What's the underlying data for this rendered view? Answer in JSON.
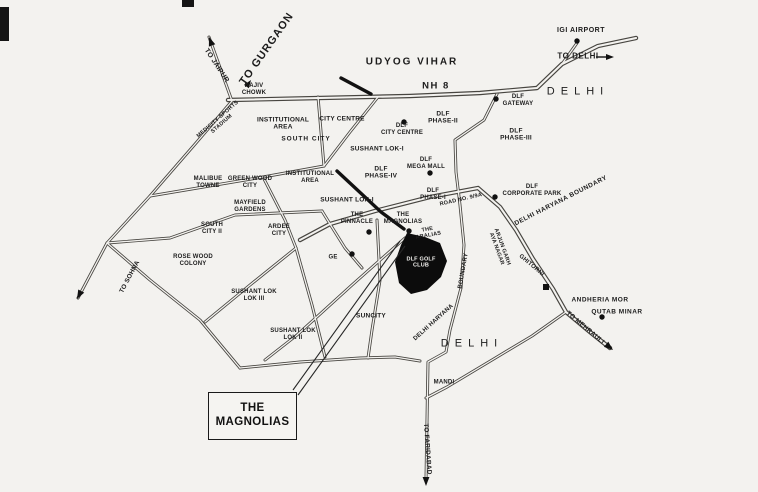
{
  "callout": {
    "text": "THE\nMAGNOLIAS"
  },
  "labels": [
    {
      "id": "to-jaipur",
      "text": "TO JAIPUR"
    },
    {
      "id": "to-gurgaon",
      "text": "TO GURGAON"
    },
    {
      "id": "udyog-vihar",
      "text": "UDYOG VIHAR"
    },
    {
      "id": "nh-8",
      "text": "NH 8"
    },
    {
      "id": "igi-airport",
      "text": "IGI AIRPORT"
    },
    {
      "id": "to-delhi",
      "text": "TO DELHI"
    },
    {
      "id": "delhi-north",
      "text": "DELHI"
    },
    {
      "id": "rajiv-chowk",
      "text": "RAJIV\nCHOWK"
    },
    {
      "id": "medicity-sports-stadium",
      "text": "MEDICITY SPORTS\nSTADIUM"
    },
    {
      "id": "institutional-area-1",
      "text": "INSTITUTIONAL\nAREA"
    },
    {
      "id": "city-centre",
      "text": "CITY CENTRE"
    },
    {
      "id": "south-city",
      "text": "SOUTH CITY"
    },
    {
      "id": "dlf-phase-2",
      "text": "DLF\nPHASE-II"
    },
    {
      "id": "dlf-gateway",
      "text": "DLF\nGATEWAY"
    },
    {
      "id": "dlf-phase-3",
      "text": "DLF\nPHASE-III"
    },
    {
      "id": "dlf-city-centre",
      "text": "DLF\nCITY CENTRE"
    },
    {
      "id": "sushant-lok-1a",
      "text": "SUSHANT LOK-I"
    },
    {
      "id": "dlf-mega-mall",
      "text": "DLF\nMEGA MALL"
    },
    {
      "id": "dlf-phase-4",
      "text": "DLF\nPHASE-IV"
    },
    {
      "id": "malibue-towne",
      "text": "MALIBUE\nTOWNE"
    },
    {
      "id": "green-wood-city",
      "text": "GREEN WOOD\nCITY"
    },
    {
      "id": "institutional-area-2",
      "text": "INSTITUTIONAL\nAREA"
    },
    {
      "id": "sushant-lok-1b",
      "text": "SUSHANT LOK-I"
    },
    {
      "id": "mayfield-gardens",
      "text": "MAYFIELD\nGARDENS"
    },
    {
      "id": "dlf-phase-1",
      "text": "DLF\nPHASE-I"
    },
    {
      "id": "road-no-9-9a",
      "text": "ROAD NO. 9/9A"
    },
    {
      "id": "dlf-corporate-park",
      "text": "DLF\nCORPORATE PARK"
    },
    {
      "id": "delhi-haryana-boundary-ne",
      "text": "DELHI HARYANA BOUNDARY"
    },
    {
      "id": "south-city-2",
      "text": "SOUTH\nCITY II"
    },
    {
      "id": "ardee-city",
      "text": "ARDEE\nCITY"
    },
    {
      "id": "rose-wood-colony",
      "text": "ROSE WOOD\nCOLONY"
    },
    {
      "id": "to-sohna",
      "text": "TO SOHNA"
    },
    {
      "id": "sushant-lok-3",
      "text": "SUSHANT LOK\nLOK III"
    },
    {
      "id": "sushant-lok-2",
      "text": "SUSHANT LOK\nLOK II"
    },
    {
      "id": "suncity",
      "text": "SUNCITY"
    },
    {
      "id": "ge",
      "text": "GE"
    },
    {
      "id": "the-pinnacle",
      "text": "THE\nPINNACLE"
    },
    {
      "id": "the-magnolias",
      "text": "THE\nMAGNOLIAS"
    },
    {
      "id": "the-aralias",
      "text": "THE\nARALIAS"
    },
    {
      "id": "dlf-golf-club",
      "text": "DLF GOLF\nCLUB"
    },
    {
      "id": "boundary-vertical",
      "text": "BOUNDARY"
    },
    {
      "id": "delhi-haryana-vertical",
      "text": "DELHI HARYANA"
    },
    {
      "id": "delhi-south",
      "text": "DELHI"
    },
    {
      "id": "mandi",
      "text": "MANDI"
    },
    {
      "id": "to-faridabad",
      "text": "TO FARIDABAD"
    },
    {
      "id": "arjun-garh-aya-nagar",
      "text": "ARJUN GARH\nAYA NAGAR"
    },
    {
      "id": "ghitorni",
      "text": "GHITORNI"
    },
    {
      "id": "andheria-mor",
      "text": "ANDHERIA MOR"
    },
    {
      "id": "qutab-minar",
      "text": "QUTAB MINAR"
    },
    {
      "id": "to-mehrauli",
      "text": "TO MEHRAULI"
    }
  ],
  "symbols": {
    "poi_dots": [
      "igi-airport",
      "dlf-gateway",
      "dlf-city-centre",
      "dlf-mega-mall",
      "dlf-corporate-park",
      "the-pinnacle",
      "the-magnolias",
      "ge",
      "qutab-minar",
      "andheria-mor"
    ],
    "arrows": [
      "to-jaipur",
      "to-gurgaon",
      "to-sohna",
      "to-delhi",
      "to-mehrauli",
      "to-faridabad"
    ],
    "area_fill": "dlf-golf-course"
  },
  "colors": {
    "paper": "#f3f2ef",
    "ink": "#1c1c1c"
  }
}
